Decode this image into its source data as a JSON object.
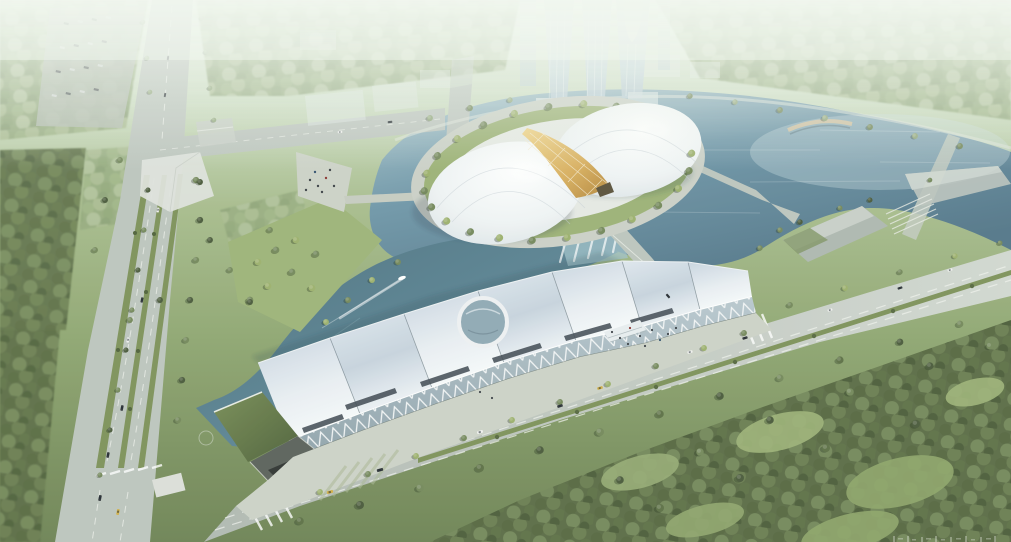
{
  "scene": {
    "kind": "aerial-architectural-rendering",
    "subjects": [
      "twin-dome-pavilion-on-lake-island",
      "gold-glazed-atrium-band",
      "sawtooth-roof-exhibition-hall-with-oculus",
      "lake-with-cascade-weir-and-boat-wake",
      "glass-towers-with-arch-gate",
      "tree-lined-boulevards-and-forest"
    ]
  },
  "palette": {
    "haze": "#eef3ec",
    "lawn": "#9ab075",
    "lawnLight": "#aabf85",
    "forest": "#5f7148",
    "forestDark": "#46573a",
    "forestLight": "#9db284",
    "water": "#6f96a8",
    "waterDeep": "#527588",
    "waterHaze": "#b7cfd4",
    "road": "#bdc5be",
    "roadLight": "#d0d6cf",
    "plaza": "#cdd2c7",
    "apron": "#e6e9e4",
    "roofLight": "#f4f7f9",
    "roofShade": "#c3cfda",
    "dome": "#f3f6f7",
    "domeShade": "#d3dce1",
    "gold": "#d8ae5e",
    "goldDeep": "#b3863b",
    "glassTower": "#cfdfe8",
    "facadeGlass": "#a9bac2",
    "greenRoof": "#5e7244",
    "carDark": "#2e3338",
    "carTaxi": "#d2af45",
    "people": "#3a3f45",
    "white": "#ffffff"
  },
  "watermark": {
    "legible": false,
    "note": "faint glyphs cropped by bottom-right image edge"
  }
}
